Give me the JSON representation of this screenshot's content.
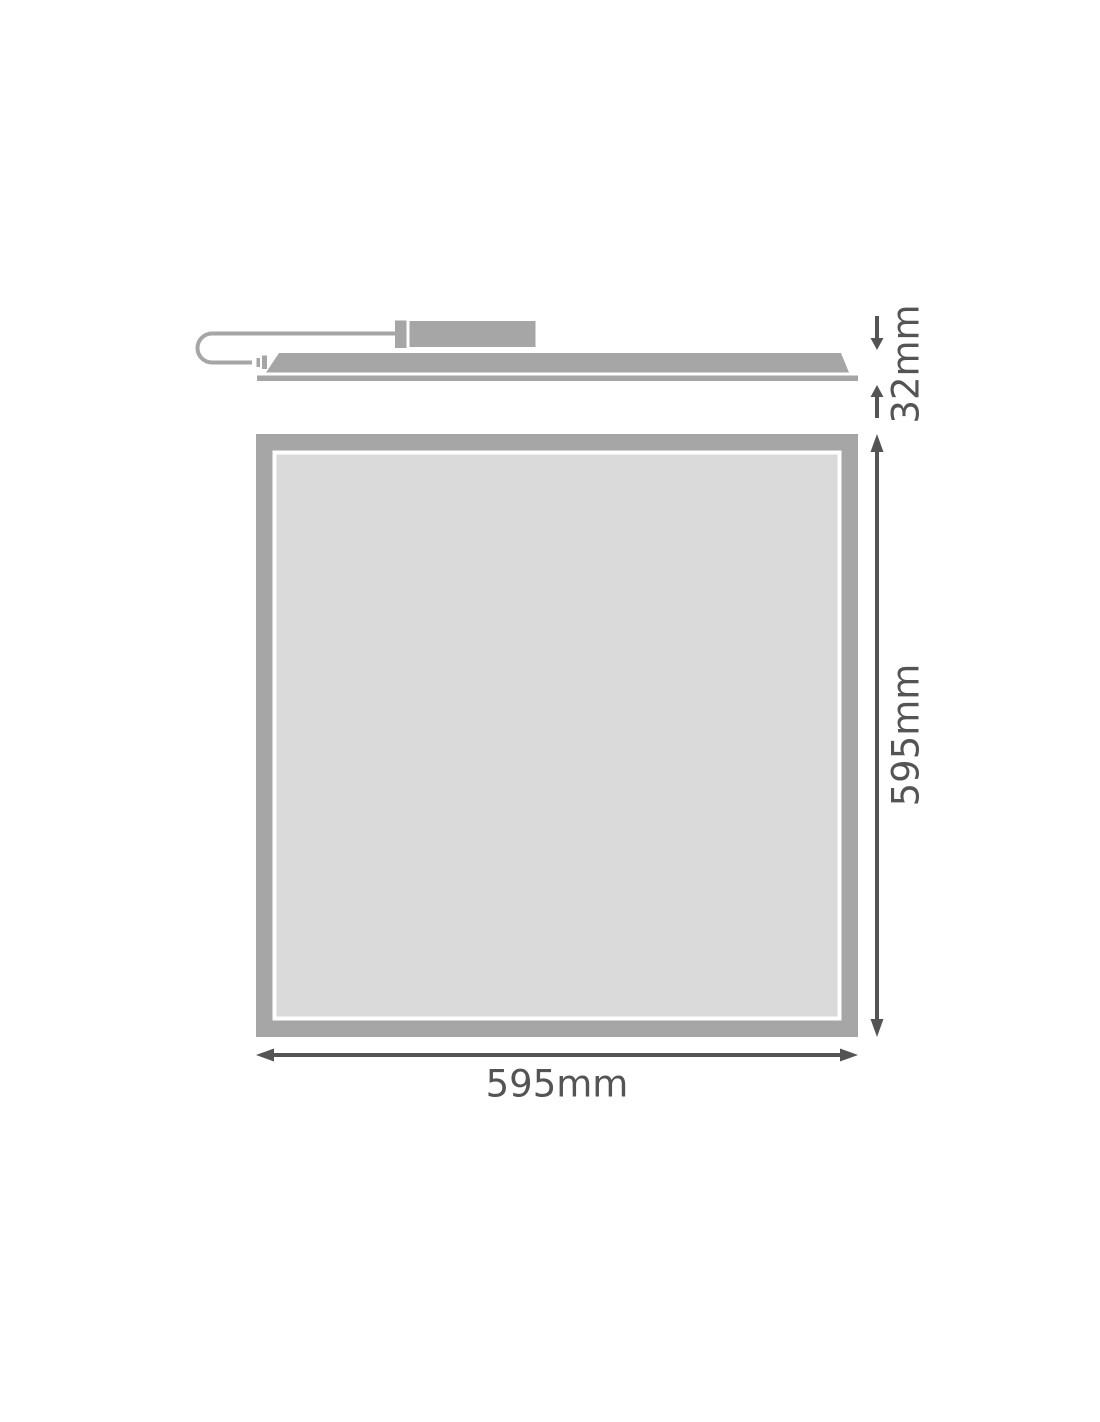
{
  "side_view": {
    "height_label": "32mm"
  },
  "front_view": {
    "height_label": "595mm",
    "width_label": "595mm"
  },
  "colors": {
    "fixture_gray": "#a6a6a6",
    "panel_face_gray": "#dadada",
    "dimension_gray": "#545454",
    "background": "#ffffff"
  }
}
